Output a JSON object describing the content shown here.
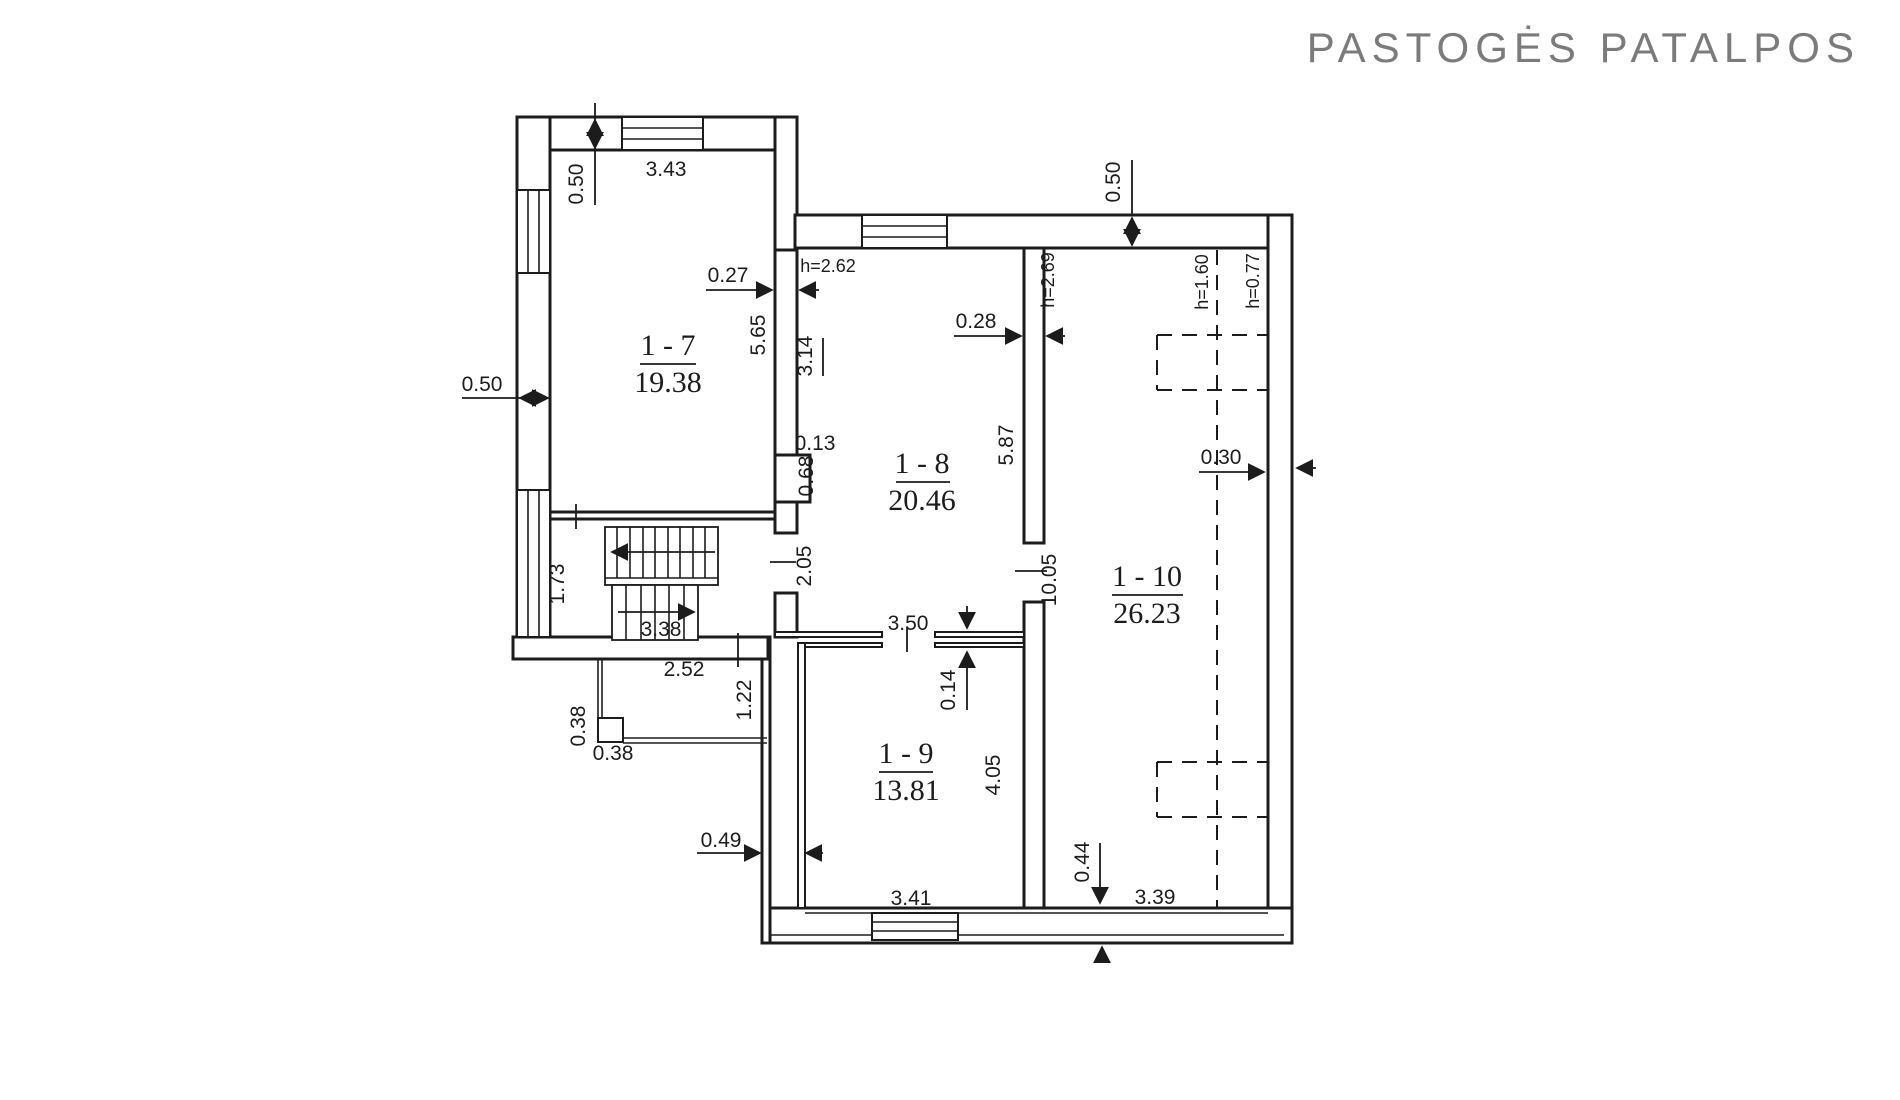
{
  "title": "PASTOGĖS PATALPOS",
  "colors": {
    "ink": "#1c1c1c",
    "title_gray": "#7b7b7b",
    "background": "#ffffff"
  },
  "rooms": [
    {
      "id": "1-7",
      "name": "1 - 7",
      "area": "19.38"
    },
    {
      "id": "1-8",
      "name": "1 - 8",
      "area": "20.46"
    },
    {
      "id": "1-9",
      "name": "1 - 9",
      "area": "13.81"
    },
    {
      "id": "1-10",
      "name": "1 - 10",
      "area": "26.23"
    }
  ],
  "dims": {
    "d050": "0.50",
    "d343": "3.43",
    "d565": "5.65",
    "d027": "0.27",
    "d314": "3.14",
    "d013": "0.13",
    "d068": "0.68",
    "d028": "0.28",
    "d587": "5.87",
    "d030": "0.30",
    "d173": "1.73",
    "d205": "2.05",
    "d338": "3.38",
    "d252": "2.52",
    "d122": "1.22",
    "d038": "0.38",
    "d049": "0.49",
    "d350": "3.50",
    "d014": "0.14",
    "d1005": "10.05",
    "d405": "4.05",
    "d341": "3.41",
    "d044": "0.44",
    "d339": "3.39",
    "h262": "h=2.62",
    "h269": "h=2.69",
    "h160": "h=1.60",
    "h077": "h=0.77"
  }
}
